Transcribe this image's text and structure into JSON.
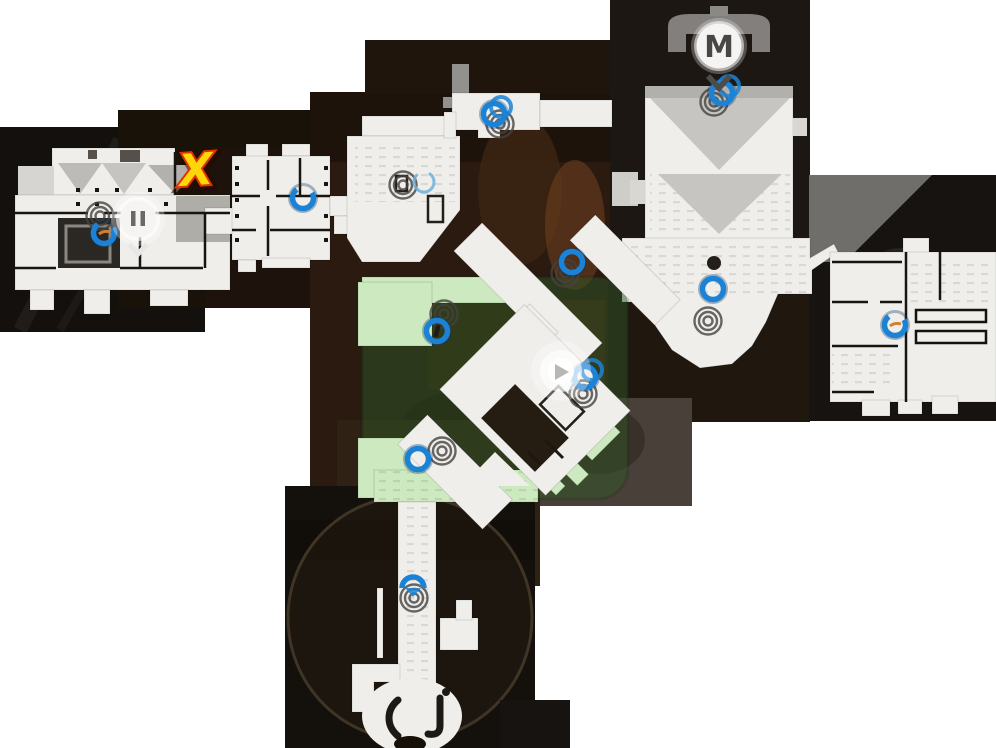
{
  "scene": {
    "background": "#ffffff",
    "width": 996,
    "height": 748,
    "description": "in-game overhead map collage"
  },
  "labels": {
    "metro_pin": "M",
    "x_mark": "X"
  },
  "colors": {
    "floor": "#efeeeb",
    "wall": "#18140f",
    "marker_blue": "#1b82d6",
    "marker_blue_halo": "#0d3a63",
    "marker_ghost": "#45423e",
    "marker_orange": "#d08030",
    "zone_green": "#2f5626",
    "zone_floor_green": "#cde9c0",
    "x_fill": "#ffd60a",
    "x_stroke": "#e03400",
    "pin_bg": "#f5f4f2",
    "pin_glyph": "#4c4c4a",
    "dot": "#241f19"
  },
  "zone": {
    "x": 362,
    "y": 277,
    "w": 266,
    "h": 222,
    "radius": 30,
    "opacity": 0.5
  },
  "markers": {
    "blue_rings": [
      {
        "x": 104,
        "y": 233,
        "variant": "open-orange"
      },
      {
        "x": 303,
        "y": 198,
        "variant": "open"
      },
      {
        "x": 424,
        "y": 182,
        "variant": "thin"
      },
      {
        "x": 494,
        "y": 114,
        "variant": "double"
      },
      {
        "x": 572,
        "y": 262,
        "variant": "plain"
      },
      {
        "x": 437,
        "y": 331,
        "variant": "bar"
      },
      {
        "x": 713,
        "y": 289,
        "variant": "plain"
      },
      {
        "x": 722,
        "y": 93,
        "variant": "double"
      },
      {
        "x": 585,
        "y": 377,
        "variant": "double"
      },
      {
        "x": 418,
        "y": 459,
        "variant": "plain"
      },
      {
        "x": 895,
        "y": 325,
        "variant": "open-orange"
      },
      {
        "x": 413,
        "y": 586,
        "variant": "arc"
      }
    ],
    "ghost_rings": [
      {
        "x": 100,
        "y": 216
      },
      {
        "x": 403,
        "y": 185
      },
      {
        "x": 500,
        "y": 124
      },
      {
        "x": 565,
        "y": 273
      },
      {
        "x": 444,
        "y": 314
      },
      {
        "x": 442,
        "y": 451
      },
      {
        "x": 708,
        "y": 321
      },
      {
        "x": 583,
        "y": 394
      },
      {
        "x": 414,
        "y": 598
      },
      {
        "x": 714,
        "y": 102
      }
    ],
    "pins": [
      {
        "type": "metro",
        "x": 719,
        "y": 46,
        "label": "M"
      },
      {
        "type": "exit",
        "x": 138,
        "y": 219
      }
    ],
    "player": {
      "x": 561,
      "y": 371
    },
    "x_mark": {
      "x": 197,
      "y": 185,
      "label": "X",
      "rotation": -4
    },
    "dark_dot": {
      "x": 714,
      "y": 263
    }
  }
}
